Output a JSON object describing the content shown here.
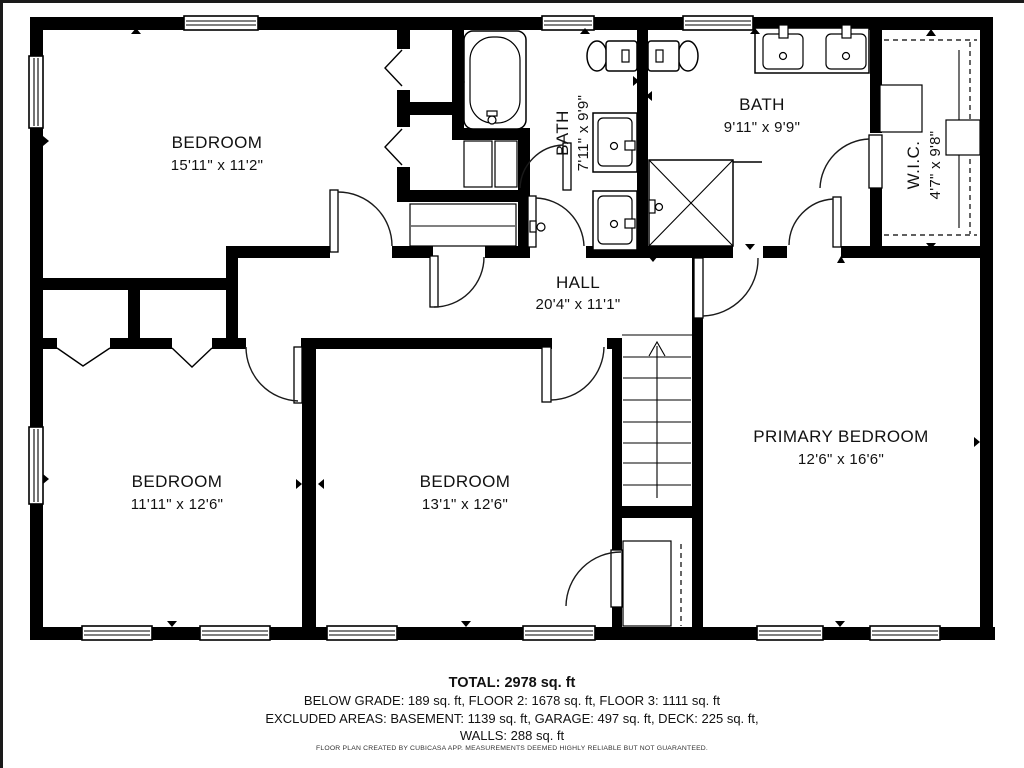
{
  "plan": {
    "rooms": [
      {
        "name": "BEDROOM",
        "dims": "15'11\" x 11'2\""
      },
      {
        "name": "BATH",
        "dims": "7'11\" x 9'9\""
      },
      {
        "name": "BATH",
        "dims": "9'11\" x 9'9\""
      },
      {
        "name": "W.I.C.",
        "dims": "4'7\" x 9'8\""
      },
      {
        "name": "HALL",
        "dims": "20'4\" x 11'1\""
      },
      {
        "name": "BEDROOM",
        "dims": "11'11\" x 12'6\""
      },
      {
        "name": "BEDROOM",
        "dims": "13'1\" x 12'6\""
      },
      {
        "name": "PRIMARY BEDROOM",
        "dims": "12'6\" x 16'6\""
      }
    ],
    "footer": {
      "total": "TOTAL: 2978 sq. ft",
      "line2": "BELOW GRADE: 189 sq. ft, FLOOR 2: 1678 sq. ft, FLOOR 3: 1111 sq. ft",
      "line3": "EXCLUDED AREAS: BASEMENT: 1139 sq. ft, GARAGE: 497 sq. ft, DECK: 225 sq. ft,",
      "line4": "WALLS: 288 sq. ft",
      "disclaimer": "FLOOR PLAN CREATED BY CUBICASA APP. MEASUREMENTS DEEMED HIGHLY RELIABLE BUT NOT GUARANTEED."
    },
    "areas_sqft": {
      "total": 2978,
      "below_grade": 189,
      "floor_2": 1678,
      "floor_3": 1111,
      "basement": 1139,
      "garage": 497,
      "deck": 225,
      "walls": 288
    },
    "fixtures": [
      "bathtub",
      "toilet",
      "sink",
      "shower",
      "stairs-up",
      "closet-rod",
      "window",
      "door"
    ],
    "colors": {
      "wall": "#000000",
      "floor": "#ffffff",
      "text": "#111111"
    }
  }
}
